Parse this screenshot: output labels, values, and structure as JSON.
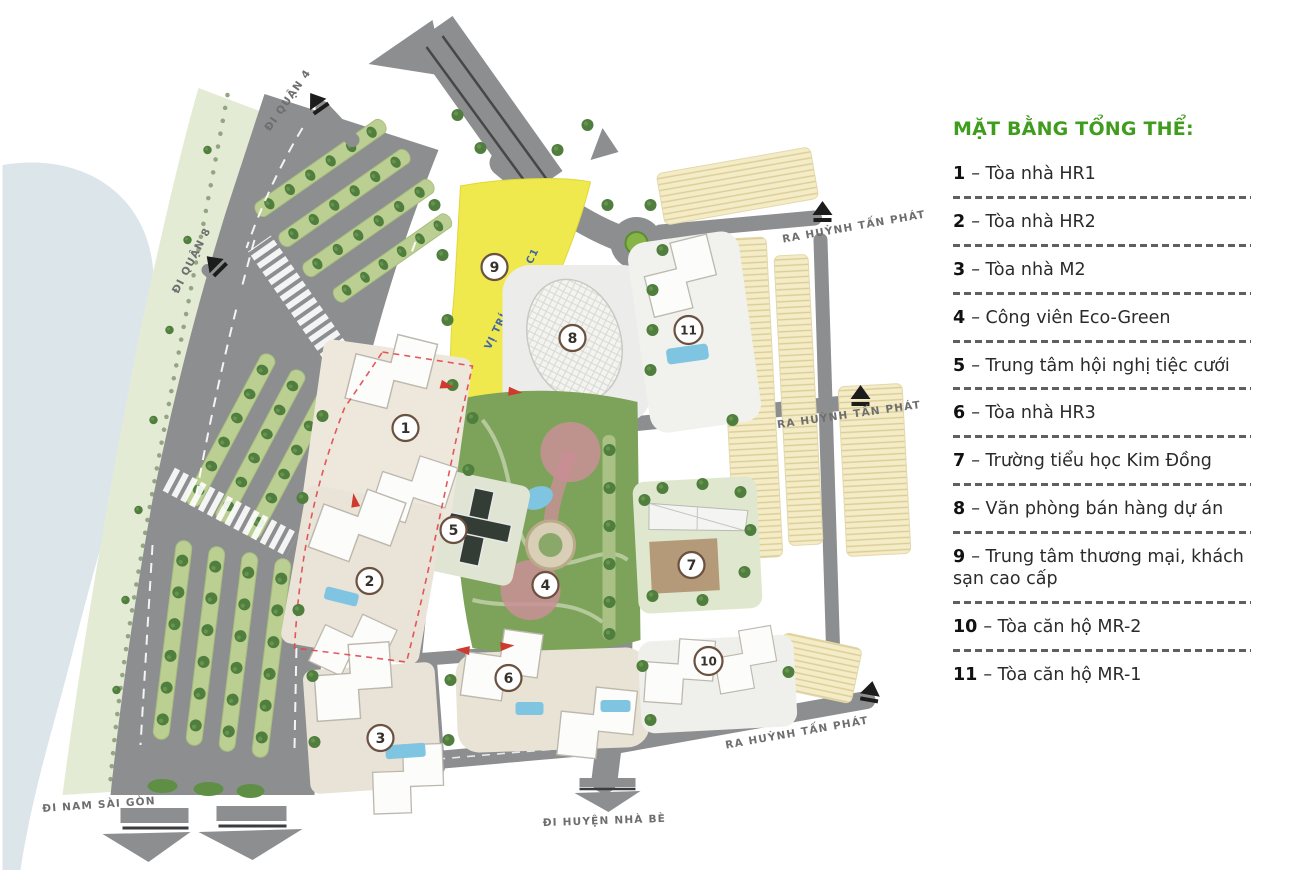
{
  "legend": {
    "title": "MẶT BẰNG TỔNG THỂ:",
    "items": [
      {
        "num": "1",
        "text": "– Tòa nhà HR1"
      },
      {
        "num": "2",
        "text": "– Tòa nhà HR2"
      },
      {
        "num": "3",
        "text": "– Tòa nhà M2"
      },
      {
        "num": "4",
        "text": "– Công viên Eco-Green"
      },
      {
        "num": "5",
        "text": "– Trung tâm hội nghị tiệc cưới"
      },
      {
        "num": "6",
        "text": "– Tòa nhà HR3"
      },
      {
        "num": "7",
        "text": "– Trường tiểu học Kim Đồng"
      },
      {
        "num": "8",
        "text": "– Văn phòng bán hàng dự án"
      },
      {
        "num": "9",
        "text": "– Trung tâm thương mại, khách sạn cao cấp"
      },
      {
        "num": "10",
        "text": "– Tòa căn hộ MR-2"
      },
      {
        "num": "11",
        "text": "– Tòa căn hộ MR-1"
      }
    ]
  },
  "map": {
    "labels": {
      "di_quan_4": "ĐI QUẬN 4",
      "di_quan_8": "ĐI QUẬN 8",
      "ra_huynh_tan_phat": "RA HUỲNH TẤN PHÁT",
      "di_nam_sai_gon": "ĐI NAM SÀI GÒN",
      "di_huyen_nha_be": "ĐI HUYỆN NHÀ BÈ",
      "lot": "VỊ TRÍ LÔ ĐẤT C1"
    },
    "markers": [
      {
        "num": "1"
      },
      {
        "num": "2"
      },
      {
        "num": "3"
      },
      {
        "num": "4"
      },
      {
        "num": "5"
      },
      {
        "num": "6"
      },
      {
        "num": "7"
      },
      {
        "num": "8"
      },
      {
        "num": "9"
      },
      {
        "num": "10"
      },
      {
        "num": "11"
      }
    ],
    "colors": {
      "legend_green": "#3f9c1d",
      "road_gray": "#8d8e90",
      "water_blue": "#dce6ea",
      "park_green": "#7da35b",
      "median_green": "#bccf92",
      "tree_green": "#4f7e3e",
      "lot_yellow": "#efe94d",
      "townhouse_cream": "#f4ecc6",
      "pool_blue": "#7fc4e0",
      "red_arrow": "#d03a2e",
      "marker_ring": "#6a5140"
    }
  }
}
